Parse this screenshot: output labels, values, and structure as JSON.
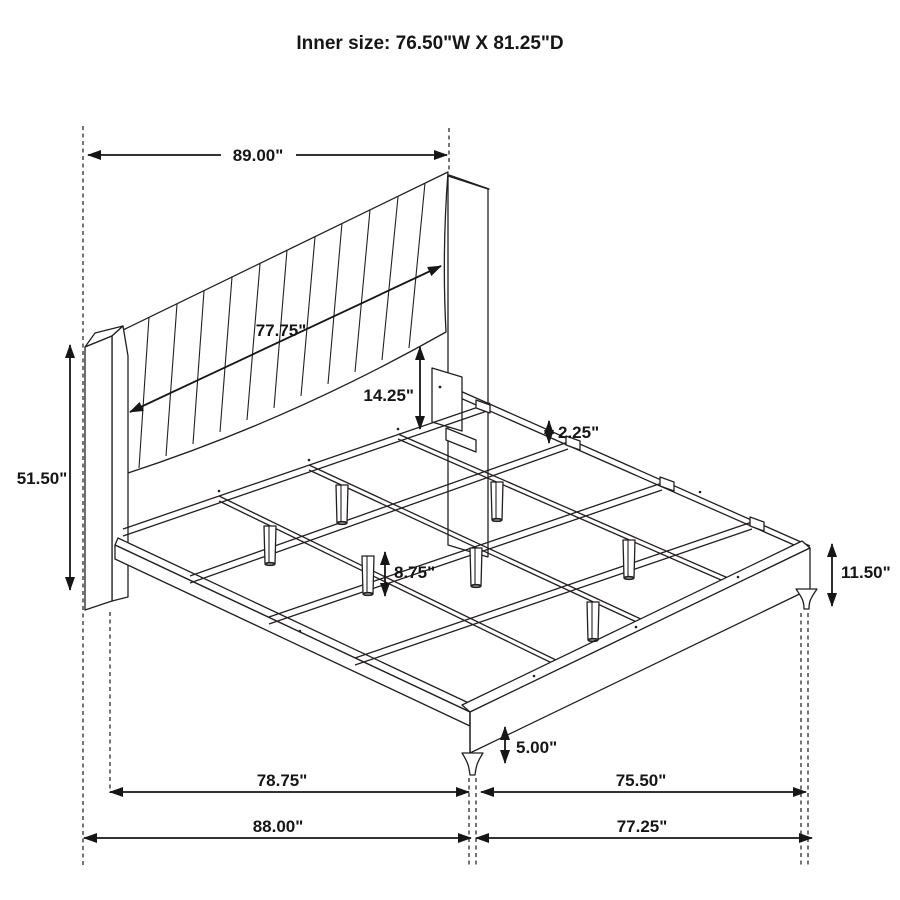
{
  "title": "Inner size: 76.50\"W X 81.25\"D",
  "dims": {
    "headboard_width": "89.00\"",
    "headboard_panel_width": "77.75\"",
    "panel_to_slat_height": "14.25\"",
    "rail_to_slat_gap": "2.25\"",
    "headboard_height": "51.50\"",
    "under_bed_clearance": "8.75\"",
    "frame_side_height": "11.50\"",
    "foot_leg_height": "5.00\"",
    "platform_length_inner": "78.75\"",
    "platform_length_outer": "88.00\"",
    "platform_width_inner": "75.50\"",
    "platform_width_outer": "77.25\""
  }
}
